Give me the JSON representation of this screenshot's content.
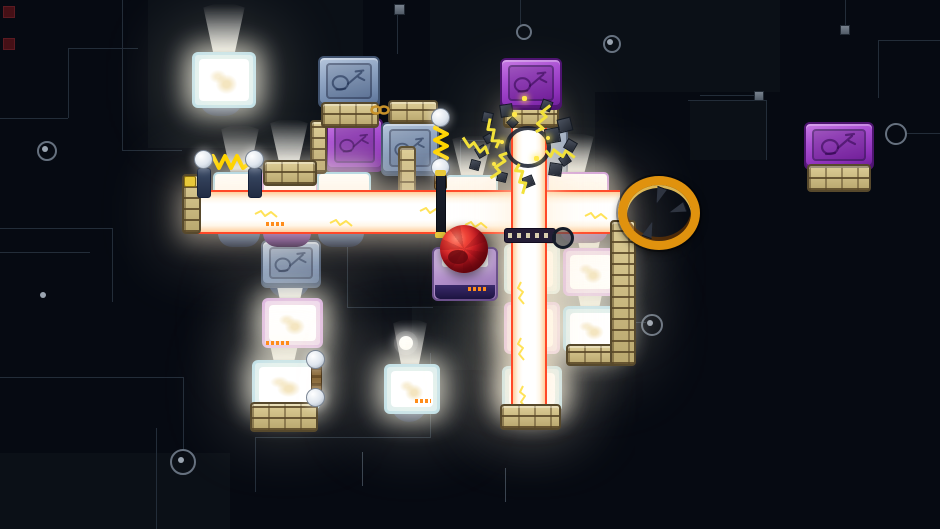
{
  "meta": {
    "app": "pixel-art puzzle platformer level",
    "visible_text": []
  },
  "palette": {
    "background": "#060a12",
    "trace": "#232d39",
    "trace_bright": "#3a4450",
    "beam_core": "#ffffff",
    "beam_edge": "#ff4828",
    "beam_warm": "#ffcf9e",
    "brick_tan": "#d3c28c",
    "block_blue": "#8fa3c0",
    "block_purple": "#9c44cc",
    "lit_frame_cyan": "#a9d6e8",
    "lit_frame_pink": "#cf9ade",
    "lit_face_white": "#ffffff",
    "spring_yellow": "#ffd400",
    "bolt_yellow": "#f2e13a",
    "ring_gold": "#e0920e",
    "ball_red": "#d41f27",
    "marker_orange": "#ff8c1a",
    "underside_blue": "#2e4f86",
    "underside_purple": "#6a2a98",
    "debris_gray": "#4a515e"
  },
  "background": {
    "patches": [
      {
        "x": 148,
        "y": 0,
        "w": 215,
        "h": 148
      },
      {
        "x": 430,
        "y": 0,
        "w": 350,
        "h": 92
      },
      {
        "x": 430,
        "y": 92,
        "w": 165,
        "h": 100
      },
      {
        "x": 412,
        "y": 306,
        "w": 128,
        "h": 64
      },
      {
        "x": 690,
        "y": 100,
        "w": 76,
        "h": 60
      },
      {
        "x": 0,
        "y": 453,
        "w": 230,
        "h": 76
      }
    ],
    "traces": [
      {
        "x": 122,
        "y": 0,
        "w": 1,
        "h": 150
      },
      {
        "x": 122,
        "y": 150,
        "w": 60,
        "h": 1
      },
      {
        "x": 68,
        "y": 48,
        "w": 70,
        "h": 1
      },
      {
        "x": 68,
        "y": 48,
        "w": 1,
        "h": 70
      },
      {
        "x": 0,
        "y": 118,
        "w": 68,
        "h": 1
      },
      {
        "x": 0,
        "y": 228,
        "w": 112,
        "h": 1
      },
      {
        "x": 112,
        "y": 228,
        "w": 1,
        "h": 74
      },
      {
        "x": 0,
        "y": 252,
        "w": 90,
        "h": 1
      },
      {
        "x": 0,
        "y": 377,
        "w": 183,
        "h": 1
      },
      {
        "x": 183,
        "y": 377,
        "w": 1,
        "h": 74
      },
      {
        "x": 156,
        "y": 428,
        "w": 1,
        "h": 101
      },
      {
        "x": 347,
        "y": 247,
        "w": 1,
        "h": 60
      },
      {
        "x": 347,
        "y": 307,
        "w": 86,
        "h": 1
      },
      {
        "x": 255,
        "y": 437,
        "w": 1,
        "h": 55
      },
      {
        "x": 255,
        "y": 437,
        "w": 176,
        "h": 1
      },
      {
        "x": 430,
        "y": 353,
        "w": 1,
        "h": 84
      },
      {
        "x": 505,
        "y": 468,
        "w": 1,
        "h": 34,
        "b": 1
      },
      {
        "x": 362,
        "y": 452,
        "w": 1,
        "h": 34,
        "b": 1
      },
      {
        "x": 688,
        "y": 100,
        "w": 78,
        "h": 1
      },
      {
        "x": 766,
        "y": 100,
        "w": 1,
        "h": 60
      },
      {
        "x": 700,
        "y": 95,
        "w": 56,
        "h": 1
      },
      {
        "x": 845,
        "y": 0,
        "w": 1,
        "h": 27
      },
      {
        "x": 878,
        "y": 40,
        "w": 62,
        "h": 1
      },
      {
        "x": 878,
        "y": 40,
        "w": 1,
        "h": 58
      },
      {
        "x": 905,
        "y": 133,
        "w": 35,
        "h": 1
      },
      {
        "x": 632,
        "y": 322,
        "w": 14,
        "h": 1
      },
      {
        "x": 397,
        "y": 14,
        "w": 1,
        "h": 40
      },
      {
        "x": 520,
        "y": 0,
        "w": 1,
        "h": 26
      },
      {
        "x": 460,
        "y": 140,
        "w": 1,
        "h": 52
      },
      {
        "x": 460,
        "y": 140,
        "w": 40,
        "h": 1
      }
    ],
    "nodes": [
      {
        "x": 37,
        "y": 141,
        "r": 8,
        "t": "ringdot"
      },
      {
        "x": 170,
        "y": 449,
        "r": 11,
        "t": "ringdot"
      },
      {
        "x": 603,
        "y": 35,
        "r": 7,
        "t": "ringdot"
      },
      {
        "x": 641,
        "y": 314,
        "r": 9,
        "t": "ringdot"
      },
      {
        "x": 885,
        "y": 123,
        "r": 9,
        "t": "ring"
      },
      {
        "x": 516,
        "y": 24,
        "r": 6,
        "t": "ring"
      },
      {
        "x": 40,
        "y": 292,
        "r": 3,
        "t": "dot"
      },
      {
        "x": 399,
        "y": 336,
        "r": 7,
        "t": "glow"
      }
    ],
    "squares": [
      {
        "x": 233,
        "y": 68,
        "s": 9
      },
      {
        "x": 394,
        "y": 4,
        "s": 9
      },
      {
        "x": 754,
        "y": 91,
        "s": 8
      },
      {
        "x": 840,
        "y": 25,
        "s": 8
      }
    ],
    "red_squares": [
      {
        "x": 3,
        "y": 6,
        "s": 10
      },
      {
        "x": 3,
        "y": 38,
        "s": 10
      }
    ]
  },
  "scene": {
    "beams": [
      {
        "name": "light-beam-horizontal",
        "o": "h",
        "x": 186,
        "y": 190,
        "w": 434,
        "h": 40
      },
      {
        "name": "light-beam-vertical",
        "o": "v",
        "x": 511,
        "y": 110,
        "w": 32,
        "h": 300
      }
    ],
    "cracks": [
      {
        "x": 255,
        "y": 203
      },
      {
        "x": 330,
        "y": 212
      },
      {
        "x": 420,
        "y": 200
      },
      {
        "x": 465,
        "y": 214
      },
      {
        "x": 585,
        "y": 205
      },
      {
        "x": 517,
        "y": 282,
        "v": 1
      },
      {
        "x": 517,
        "y": 338,
        "v": 1
      },
      {
        "x": 519,
        "y": 386,
        "v": 1
      }
    ],
    "cones": [
      {
        "x": 220,
        "y": 126,
        "w": 40,
        "h": 46
      },
      {
        "x": 269,
        "y": 120,
        "w": 40,
        "h": 44
      },
      {
        "x": 327,
        "y": 132,
        "w": 42,
        "h": 44
      },
      {
        "x": 451,
        "y": 136,
        "w": 42,
        "h": 42
      },
      {
        "x": 553,
        "y": 134,
        "w": 42,
        "h": 40
      }
    ],
    "blocks": [
      {
        "name": "lamp-block-top-left",
        "kind": "lit",
        "variant": "cyan",
        "x": 192,
        "y": 52,
        "w": 58,
        "h": 50,
        "float": "blue",
        "cone": {
          "x": 202,
          "y": 4,
          "w": 44,
          "h": 50
        }
      },
      {
        "name": "icon-block-top-blue",
        "kind": "icon",
        "variant": "blue",
        "x": 318,
        "y": 56,
        "w": 58,
        "h": 48,
        "base": {
          "x": 321,
          "y": 102,
          "w": 54,
          "h": 22
        }
      },
      {
        "name": "icon-block-mid-purple",
        "kind": "icon",
        "variant": "purple",
        "x": 326,
        "y": 118,
        "w": 53,
        "h": 50
      },
      {
        "name": "icon-block-mid-blue",
        "kind": "icon",
        "variant": "blue",
        "x": 381,
        "y": 122,
        "w": 54,
        "h": 50
      },
      {
        "name": "icon-block-top-center-purple",
        "kind": "icon",
        "variant": "purple",
        "x": 500,
        "y": 58,
        "w": 58,
        "h": 48,
        "z": 6,
        "base": {
          "x": 503,
          "y": 104,
          "w": 52,
          "h": 20
        }
      },
      {
        "name": "icon-block-far-right-purple",
        "kind": "icon",
        "variant": "purple",
        "x": 804,
        "y": 122,
        "w": 66,
        "h": 44,
        "base": {
          "x": 807,
          "y": 164,
          "w": 60,
          "h": 24
        }
      },
      {
        "name": "icon-block-lower-left-blue",
        "kind": "icon",
        "variant": "blue",
        "x": 261,
        "y": 240,
        "w": 56,
        "h": 44,
        "float": "blue"
      },
      {
        "name": "block-behind-burst",
        "kind": "plain",
        "x": 540,
        "y": 128,
        "w": 24,
        "h": 44
      },
      {
        "name": "beam-row-top-1",
        "kind": "top",
        "variant": "cyan",
        "x": 213,
        "y": 172,
        "w": 46,
        "h": 20
      },
      {
        "name": "beam-row-top-2",
        "kind": "top",
        "variant": "pink",
        "x": 262,
        "y": 170,
        "w": 52,
        "h": 22
      },
      {
        "name": "beam-row-top-3",
        "kind": "top",
        "variant": "cyan",
        "x": 317,
        "y": 172,
        "w": 50,
        "h": 20
      },
      {
        "name": "beam-row-top-4",
        "kind": "top",
        "variant": "cyan",
        "x": 445,
        "y": 175,
        "w": 49,
        "h": 17
      },
      {
        "name": "beam-row-top-5",
        "kind": "top",
        "variant": "pink",
        "x": 547,
        "y": 172,
        "w": 58,
        "h": 20
      },
      {
        "name": "beam-row-bottom-1",
        "kind": "bottom",
        "variant": "blue",
        "x": 218,
        "y": 229,
        "w": 42,
        "h": 18
      },
      {
        "name": "beam-row-bottom-2",
        "kind": "bottom",
        "variant": "purple",
        "x": 263,
        "y": 229,
        "w": 48,
        "h": 18
      },
      {
        "name": "beam-row-bottom-3",
        "kind": "bottom",
        "variant": "blue",
        "x": 318,
        "y": 229,
        "w": 46,
        "h": 18
      },
      {
        "name": "beam-row-bottom-4",
        "kind": "bottom",
        "variant": "purple",
        "x": 560,
        "y": 229,
        "w": 48,
        "h": 14
      },
      {
        "name": "pusher-block-under-ball",
        "kind": "pusher",
        "x": 432,
        "y": 247,
        "w": 62,
        "h": 50
      },
      {
        "name": "center-column-lit-1",
        "kind": "lit",
        "variant": "cyan",
        "x": 504,
        "y": 244,
        "w": 50,
        "h": 44
      },
      {
        "name": "center-column-lit-2",
        "kind": "lit",
        "variant": "pink",
        "x": 504,
        "y": 302,
        "w": 50,
        "h": 46
      },
      {
        "name": "center-column-lit-bottom",
        "kind": "lit",
        "variant": "cyan",
        "x": 502,
        "y": 366,
        "w": 54,
        "h": 40,
        "base": {
          "x": 500,
          "y": 404,
          "w": 57,
          "h": 22
        }
      },
      {
        "name": "right-column-lit-purple",
        "kind": "lit",
        "variant": "pink",
        "x": 563,
        "y": 248,
        "w": 50,
        "h": 42,
        "cone": {
          "x": 570,
          "y": 204,
          "w": 38,
          "h": 46
        }
      },
      {
        "name": "right-column-lit-cyan",
        "kind": "lit",
        "variant": "cyan",
        "x": 563,
        "y": 306,
        "w": 52,
        "h": 40,
        "base": {
          "x": 566,
          "y": 344,
          "w": 50,
          "h": 18
        },
        "cone": {
          "x": 571,
          "y": 264,
          "w": 38,
          "h": 44
        }
      },
      {
        "name": "bottom-left-lit-pink",
        "kind": "lit",
        "variant": "pink",
        "x": 262,
        "y": 298,
        "w": 55,
        "h": 44,
        "cone": {
          "x": 269,
          "y": 252,
          "w": 42,
          "h": 48
        }
      },
      {
        "name": "bottom-left-lit-cyan",
        "kind": "lit",
        "variant": "cyan",
        "x": 252,
        "y": 360,
        "w": 62,
        "h": 44,
        "base": {
          "x": 250,
          "y": 402,
          "w": 64,
          "h": 26
        },
        "cone": {
          "x": 263,
          "y": 316,
          "w": 42,
          "h": 46
        }
      },
      {
        "name": "bottom-center-lit",
        "kind": "lit",
        "variant": "cyan",
        "x": 384,
        "y": 364,
        "w": 50,
        "h": 44,
        "float": "blue",
        "cone": {
          "x": 392,
          "y": 320,
          "w": 36,
          "h": 46
        }
      }
    ],
    "platforms": [
      {
        "name": "brick-platform-on-beam",
        "x": 263,
        "y": 160,
        "w": 50,
        "h": 22
      },
      {
        "name": "brick-platform-chain",
        "x": 388,
        "y": 100,
        "w": 46,
        "h": 20
      },
      {
        "name": "brick-pillar-left",
        "x": 310,
        "y": 120,
        "w": 13,
        "h": 50,
        "z": 3
      },
      {
        "name": "brick-pillar-mid",
        "x": 398,
        "y": 146,
        "w": 14,
        "h": 46,
        "z": 3
      },
      {
        "name": "brick-pillar-right",
        "x": 610,
        "y": 220,
        "w": 22,
        "h": 142
      },
      {
        "name": "brick-beam-endcap",
        "x": 182,
        "y": 174,
        "w": 15,
        "h": 56
      }
    ],
    "springs": [
      {
        "name": "spring-horizontal",
        "orient": "h",
        "x": 194,
        "y": 150
      },
      {
        "name": "spring-vertical",
        "orient": "v",
        "x": 430,
        "y": 108
      }
    ],
    "pole": {
      "name": "bulb-pole",
      "x": 306,
      "y": 350
    },
    "separator": {
      "name": "beam-separator-bar",
      "x": 436,
      "y": 172,
      "w": 8,
      "h": 62
    },
    "rail": {
      "name": "dotted-rail",
      "x": 504,
      "y": 228,
      "w": 50,
      "h": 13,
      "ring": {
        "x": 552,
        "y": 227,
        "d": 16
      }
    },
    "chain": {
      "name": "chain-link",
      "x": 370,
      "y": 101
    },
    "ring": {
      "name": "goal-ring",
      "x": 618,
      "y": 176,
      "w": 64,
      "h": 56,
      "claws": [
        {
          "x": 26,
          "y": 2,
          "rot": 200
        },
        {
          "x": 44,
          "y": 16,
          "rot": 250
        },
        {
          "x": 16,
          "y": 36,
          "rot": 20
        }
      ]
    },
    "ball": {
      "name": "red-ball-player",
      "x": 440,
      "y": 225,
      "d": 48
    },
    "burst": {
      "name": "electric-burst",
      "arc": {
        "x": 505,
        "y": 126,
        "d": 38
      },
      "bolts": [
        {
          "x": 486,
          "y": 118,
          "r": -15
        },
        {
          "x": 536,
          "y": 104,
          "r": 25
        },
        {
          "x": 552,
          "y": 140,
          "r": 100
        },
        {
          "x": 490,
          "y": 150,
          "r": 210
        },
        {
          "x": 512,
          "y": 164,
          "r": 170
        },
        {
          "x": 468,
          "y": 130,
          "r": -60
        }
      ],
      "debris": [
        {
          "x": 482,
          "y": 112,
          "s": 9,
          "r": 12
        },
        {
          "x": 500,
          "y": 104,
          "s": 11,
          "r": -8
        },
        {
          "x": 541,
          "y": 100,
          "s": 9,
          "r": 20
        },
        {
          "x": 558,
          "y": 118,
          "s": 12,
          "r": -14
        },
        {
          "x": 565,
          "y": 140,
          "s": 9,
          "r": 30
        },
        {
          "x": 549,
          "y": 163,
          "s": 11,
          "r": 8
        },
        {
          "x": 523,
          "y": 176,
          "s": 9,
          "r": -22
        },
        {
          "x": 497,
          "y": 172,
          "s": 8,
          "r": 14
        },
        {
          "x": 476,
          "y": 146,
          "s": 9,
          "r": -30
        },
        {
          "x": 508,
          "y": 118,
          "s": 7,
          "r": 45
        },
        {
          "x": 545,
          "y": 128,
          "s": 13,
          "r": -10
        },
        {
          "x": 484,
          "y": 134,
          "s": 7,
          "r": 60
        },
        {
          "x": 470,
          "y": 160,
          "s": 8,
          "r": 15
        },
        {
          "x": 560,
          "y": 155,
          "s": 8,
          "r": -35
        }
      ],
      "sparks": [
        {
          "x": 512,
          "y": 112,
          "s": 5
        },
        {
          "x": 534,
          "y": 156,
          "s": 5
        },
        {
          "x": 500,
          "y": 140,
          "s": 4
        },
        {
          "x": 546,
          "y": 136,
          "s": 4
        },
        {
          "x": 522,
          "y": 96,
          "s": 5
        },
        {
          "x": 492,
          "y": 162,
          "s": 4
        }
      ]
    },
    "markers": [
      {
        "x": 266,
        "y": 341,
        "w": 24
      },
      {
        "x": 468,
        "y": 287,
        "w": 20
      },
      {
        "x": 415,
        "y": 399,
        "w": 16
      },
      {
        "x": 266,
        "y": 222,
        "w": 18
      }
    ]
  }
}
